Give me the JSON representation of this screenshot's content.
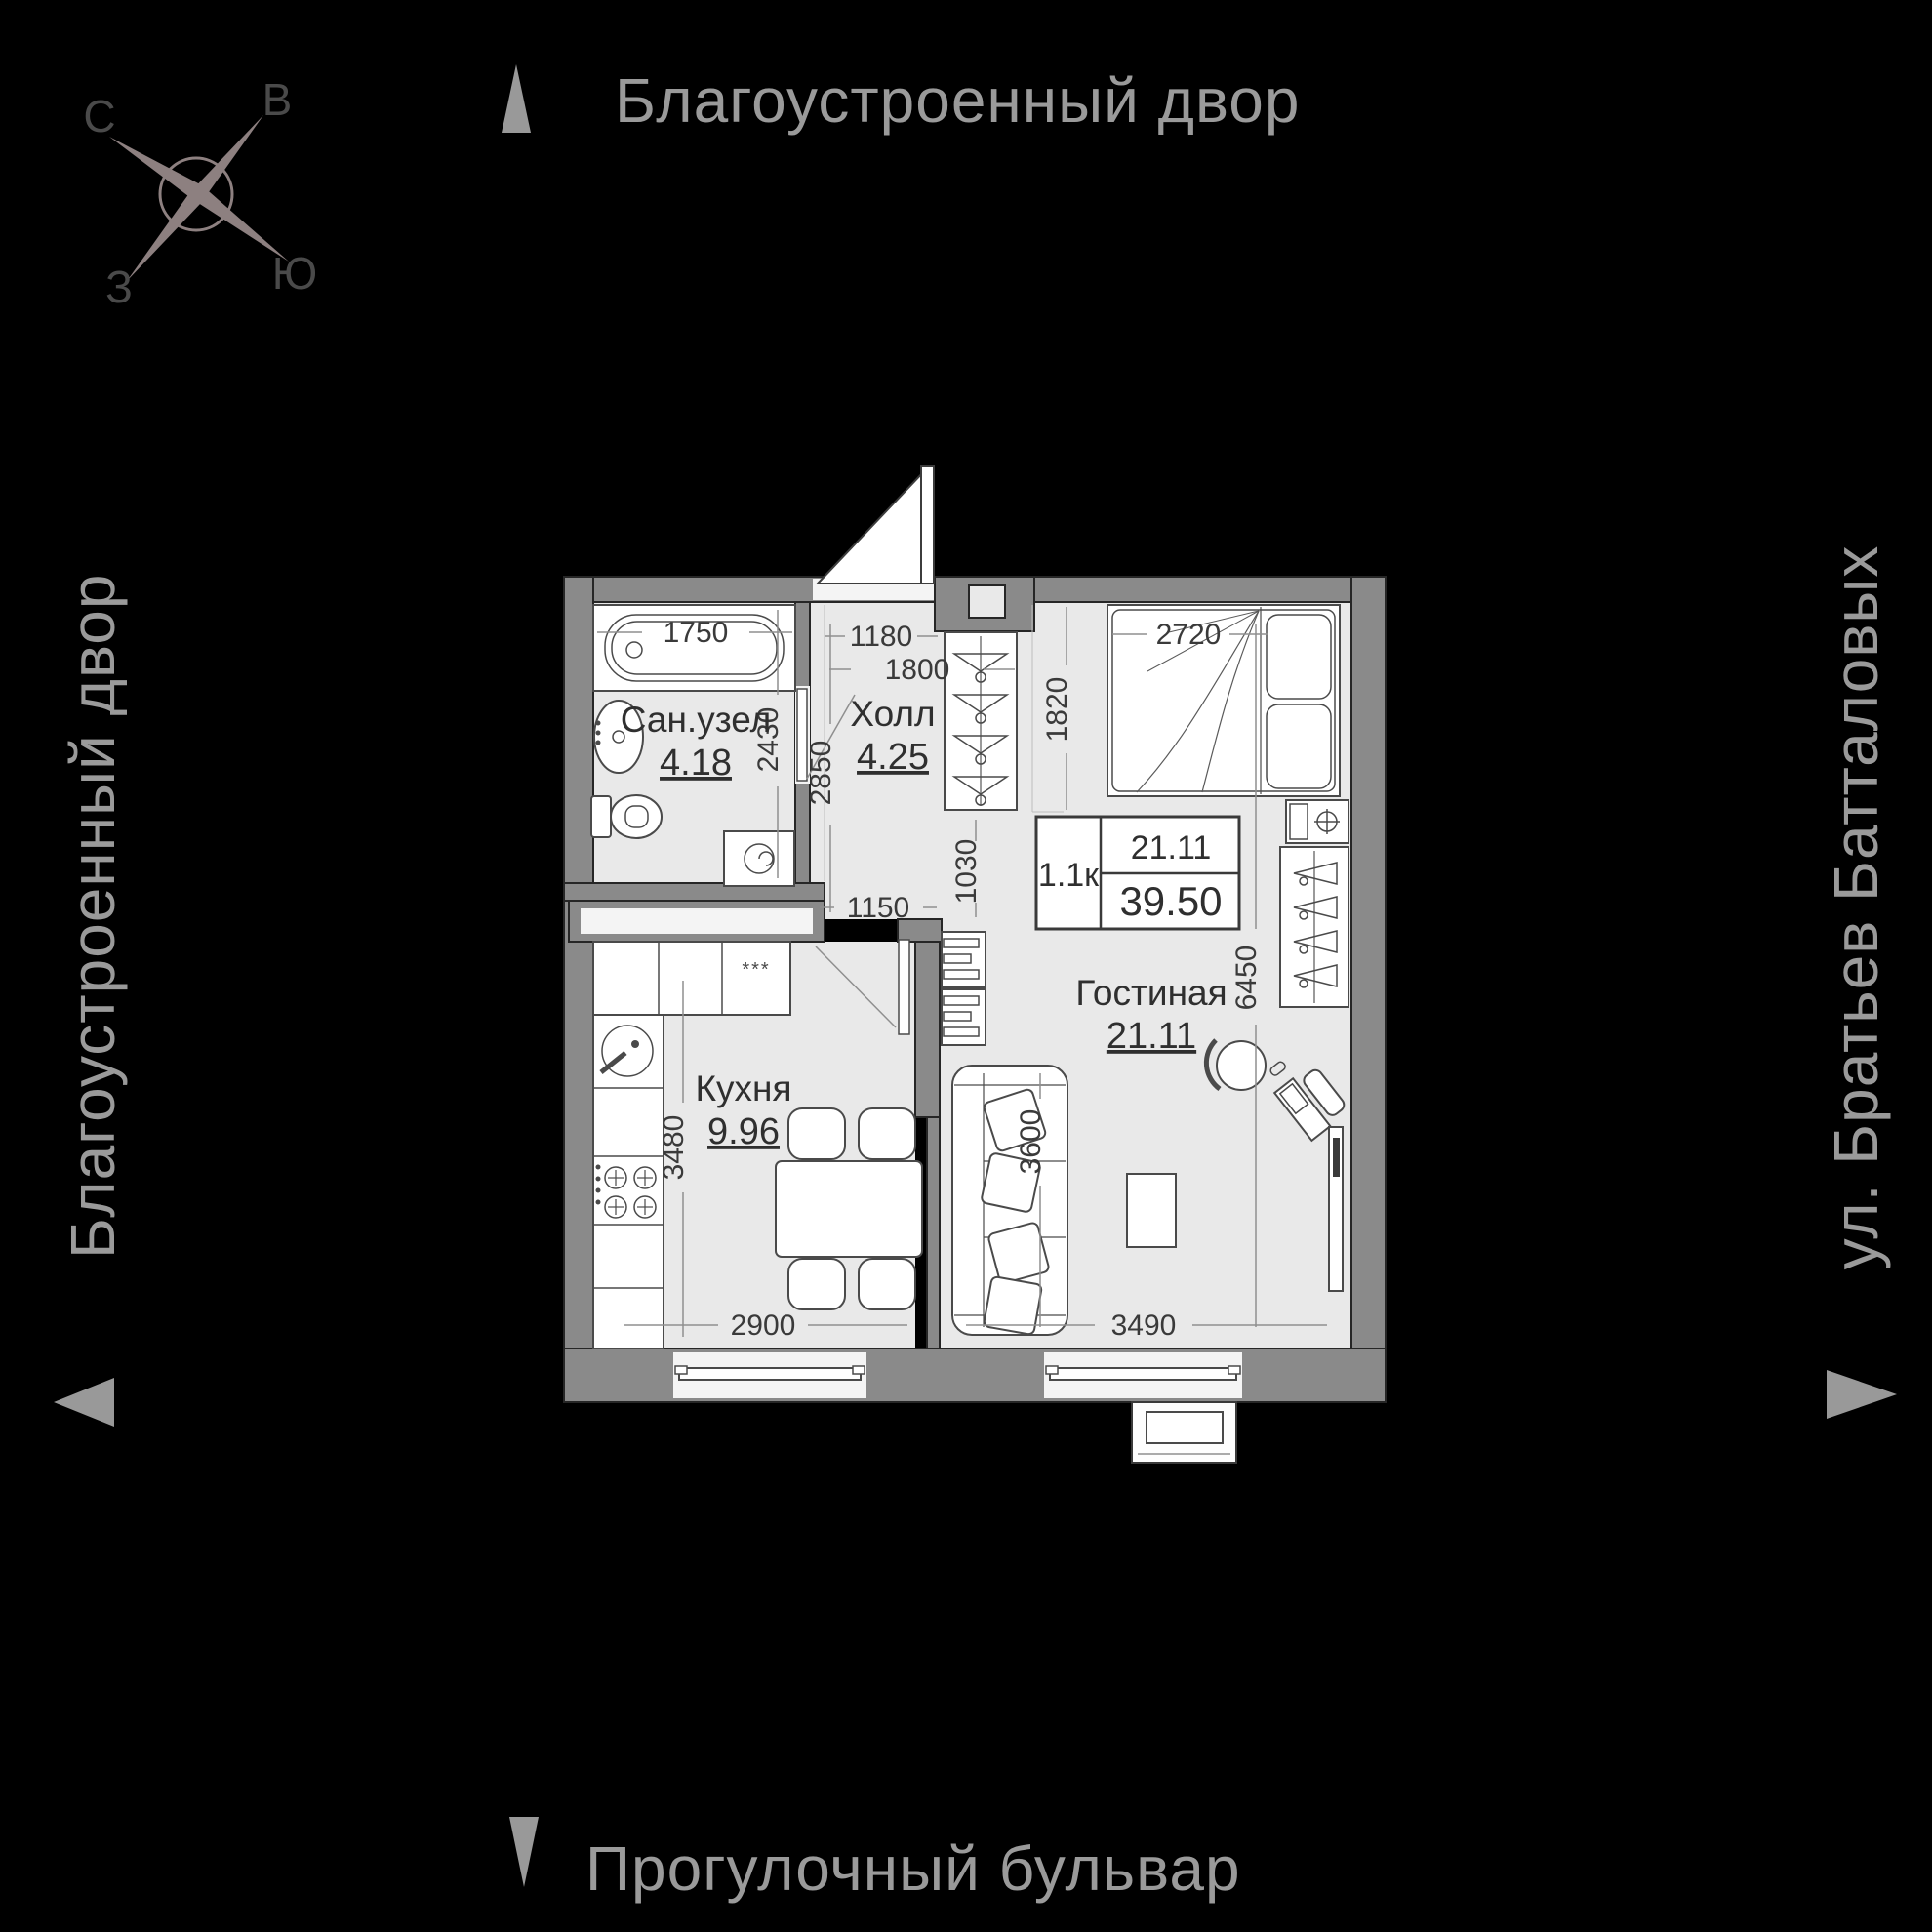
{
  "streets": {
    "top": "Благоустроенный двор",
    "left": "Благоустроенный двор",
    "right": "ул. Братьев Батталовых",
    "bottom": "Прогулочный бульвар"
  },
  "compass": {
    "north": "С",
    "east": "В",
    "west": "З",
    "south": "Ю"
  },
  "info_box": {
    "type": "1.1к",
    "living_area": "21.11",
    "total_area": "39.50"
  },
  "rooms": {
    "bathroom": {
      "name": "Сан.узел",
      "area": "4.18"
    },
    "hall": {
      "name": "Холл",
      "area": "4.25"
    },
    "kitchen": {
      "name": "Кухня",
      "area": "9.96"
    },
    "living": {
      "name": "Гостиная",
      "area": "21.11"
    }
  },
  "dims": {
    "bathtub": "1750",
    "hall_width": "1180",
    "hall_entry": "1800",
    "bed_width": "2720",
    "bed_depth": "1820",
    "bathroom_depth": "2430",
    "hall_depth": "2850",
    "opening": "1030",
    "hall_passage": "1150",
    "living_depth": "6450",
    "kitchen_depth": "3480",
    "sofa_length": "3600",
    "kitchen_width": "2900",
    "living_width": "3490"
  },
  "fridge_stars": "***",
  "colors": {
    "background": "#000000",
    "street_text": "#9a9a9a",
    "walls": "#8a8a8a",
    "floor": "#e9e9e9",
    "labels": "#3a3a3a",
    "compass": "#8d8080"
  }
}
